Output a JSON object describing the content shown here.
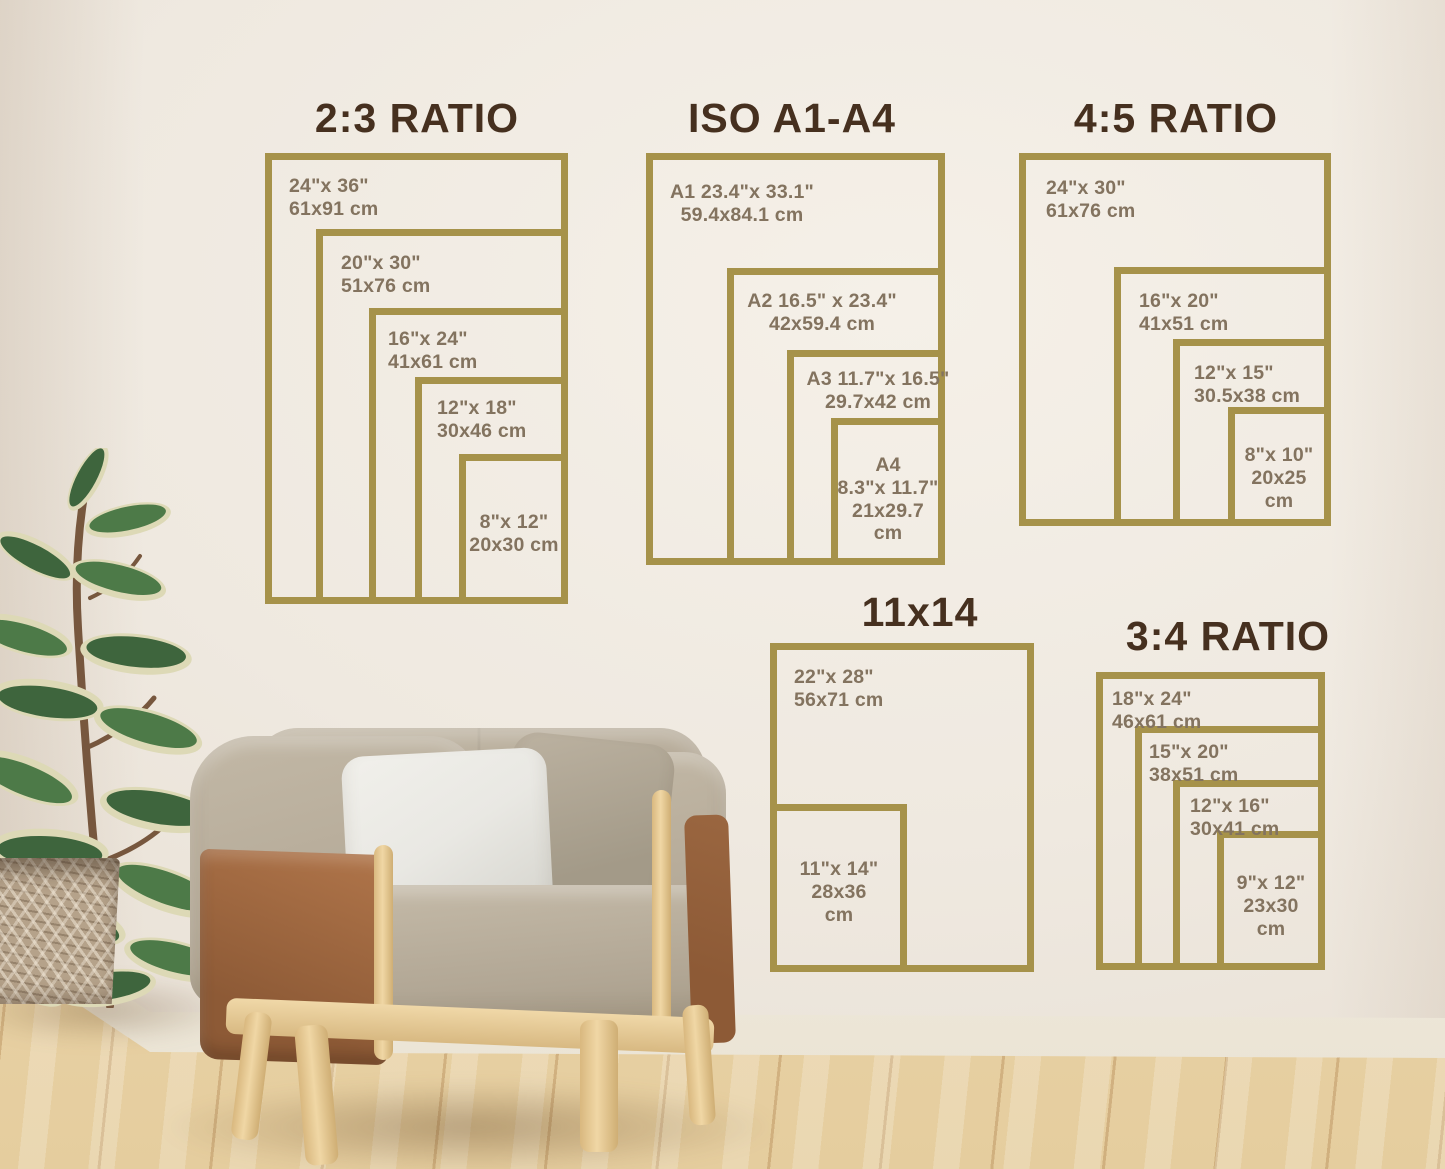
{
  "scene": {
    "description": "print size guide wall chart above an armchair and potted plant",
    "colors": {
      "frame": "#a6924a",
      "title-text": "#46301f",
      "label-text": "#83735f",
      "wall-b": "#efe9e0",
      "floor-a": "#f2e2bf",
      "leather": "#b0754a",
      "fabric": "#b6ab99",
      "pillow": "#e9e8e3",
      "pot": "#b5a28a",
      "leaf-dark": "#3e653d",
      "leaf-cream": "#ddd9b6",
      "wood": "#ecd2a0"
    }
  },
  "groups": [
    {
      "title": "2:3 RATIO",
      "sizes": [
        {
          "label": "24\"x 36\"\n61x91 cm"
        },
        {
          "label": "20\"x 30\"\n51x76 cm"
        },
        {
          "label": "16\"x 24\"\n41x61 cm"
        },
        {
          "label": "12\"x 18\"\n30x46 cm"
        },
        {
          "label": "8\"x 12\"\n20x30 cm"
        }
      ]
    },
    {
      "title": "ISO A1-A4",
      "sizes": [
        {
          "label": "A1 23.4\"x 33.1\"\n59.4x84.1 cm"
        },
        {
          "label": "A2 16.5\" x 23.4\"\n42x59.4 cm"
        },
        {
          "label": "A3 11.7\"x 16.5\"\n29.7x42 cm"
        },
        {
          "label": "A4\n8.3\"x 11.7\"\n21x29.7\ncm"
        }
      ]
    },
    {
      "title": "4:5 RATIO",
      "sizes": [
        {
          "label": "24\"x 30\"\n61x76 cm"
        },
        {
          "label": "16\"x 20\"\n41x51 cm"
        },
        {
          "label": "12\"x 15\"\n30.5x38 cm"
        },
        {
          "label": "8\"x 10\"\n20x25\ncm"
        }
      ]
    },
    {
      "title": "11x14",
      "sizes": [
        {
          "label": "22\"x 28\"\n56x71 cm"
        },
        {
          "label": "11\"x 14\"\n28x36\ncm"
        }
      ]
    },
    {
      "title": "3:4 RATIO",
      "sizes": [
        {
          "label": "18\"x 24\"\n46x61 cm"
        },
        {
          "label": "15\"x 20\"\n38x51 cm"
        },
        {
          "label": "12\"x 16\"\n30x41 cm"
        },
        {
          "label": "9\"x 12\"\n23x30\ncm"
        }
      ]
    }
  ]
}
